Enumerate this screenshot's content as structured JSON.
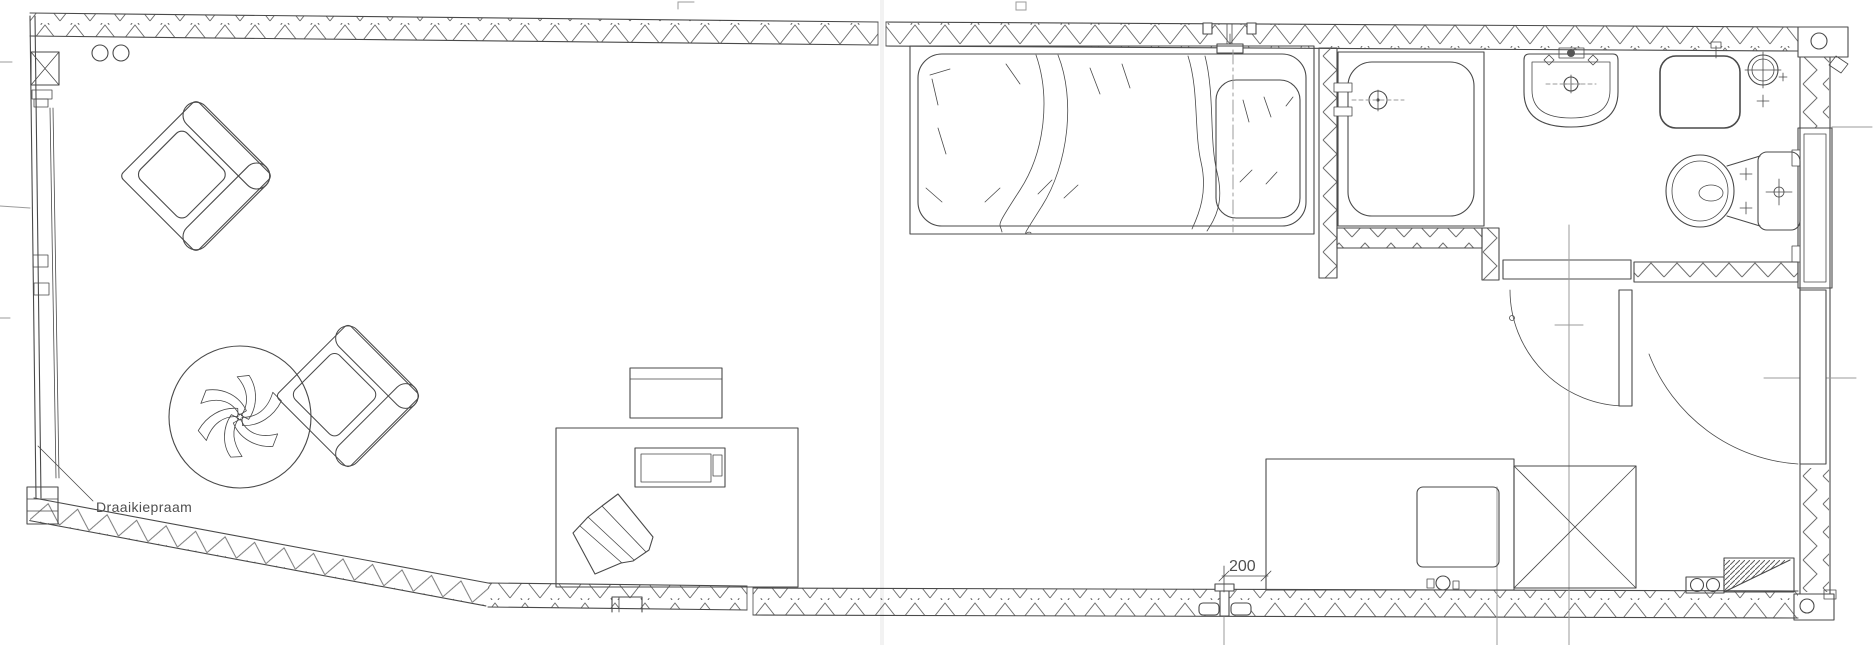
{
  "page": {
    "background": "#ffffff",
    "ink": "#4a4a4a",
    "ink_light": "#9b9b9b",
    "hatch": "#6f6f6f"
  },
  "labels": {
    "window_label": "Draaikiepraam",
    "dimension_value": "200"
  },
  "drawing": {
    "type": "floor-plan",
    "rooms": [
      "living-room",
      "bedroom",
      "shower-room",
      "bathroom",
      "kitchenette"
    ],
    "fixtures": [
      "armchair",
      "armchair",
      "potted-plant",
      "desk",
      "desk-chair",
      "monitor-shelf",
      "laptop",
      "double-bed",
      "pillow",
      "shower-tray",
      "shower-drain",
      "washbasin",
      "square-basin",
      "extractor-fan",
      "toilet",
      "kitchen-counter",
      "appliance",
      "tall-cabinet",
      "ramp-hatch"
    ]
  }
}
